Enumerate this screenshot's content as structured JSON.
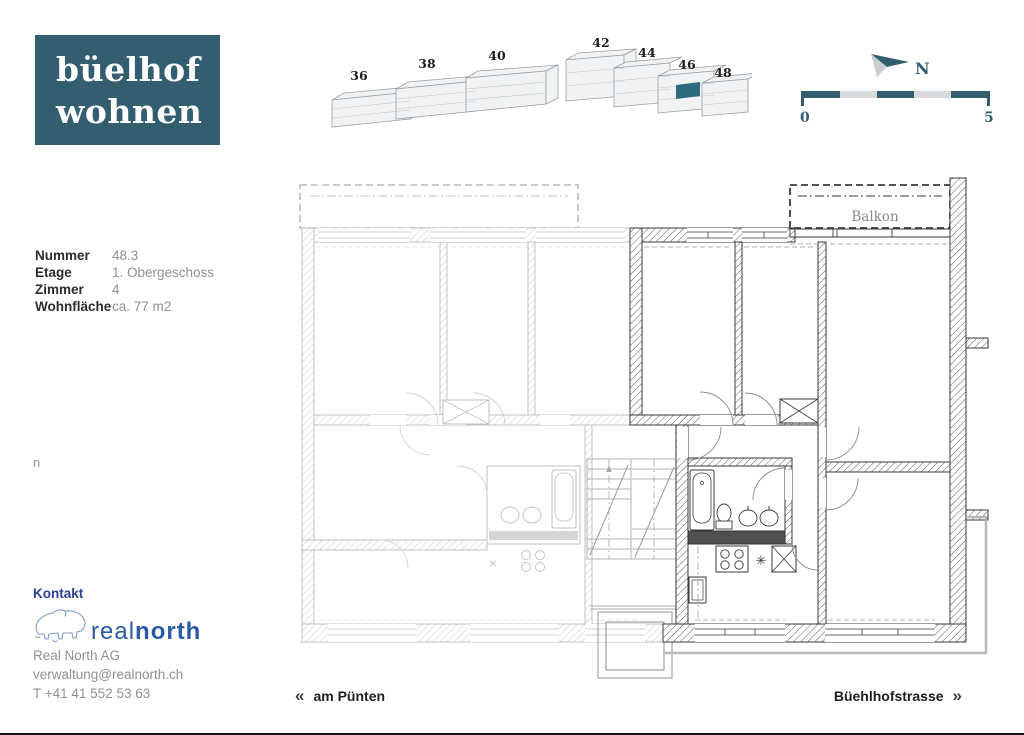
{
  "brand": {
    "line1": "büelhof",
    "line2": "wohnen"
  },
  "site_map": {
    "buildings": [
      "36",
      "38",
      "40",
      "42",
      "44",
      "46",
      "48"
    ]
  },
  "compass": {
    "north_label": "N"
  },
  "scale_bar": {
    "start_label": "0",
    "end_label": "5"
  },
  "unit_info": {
    "rows": [
      {
        "label": "Nummer",
        "value": "48.3"
      },
      {
        "label": "Etage",
        "value": "1. Obergeschoss"
      },
      {
        "label": "Zimmer",
        "value": "4"
      },
      {
        "label": "Wohnfläche",
        "value": "ca. 77 m2"
      }
    ]
  },
  "side_note": "n",
  "contact": {
    "heading": "Kontakt",
    "brand_regular": "real",
    "brand_bold": "north",
    "company": "Real North AG",
    "email": "verwaltung@realnorth.ch",
    "phone": "T +41 41 552 53 63"
  },
  "floor_plan": {
    "balcony_label": "Balkon",
    "kitchen_symbol": "✳",
    "cross_symbol": "×"
  },
  "street_nav": {
    "left_chevrons": "«",
    "left_label": "am Pünten",
    "right_label": "Büehlhofstrasse",
    "right_chevrons": "»"
  },
  "colors": {
    "brand_teal": "#335e70",
    "highlight_teal": "#2e6b80",
    "scale_light": "#d7dbde",
    "contact_blue": "#2a5aa6",
    "heading_blue": "#2b3f92",
    "gray_text": "#8f9193"
  }
}
